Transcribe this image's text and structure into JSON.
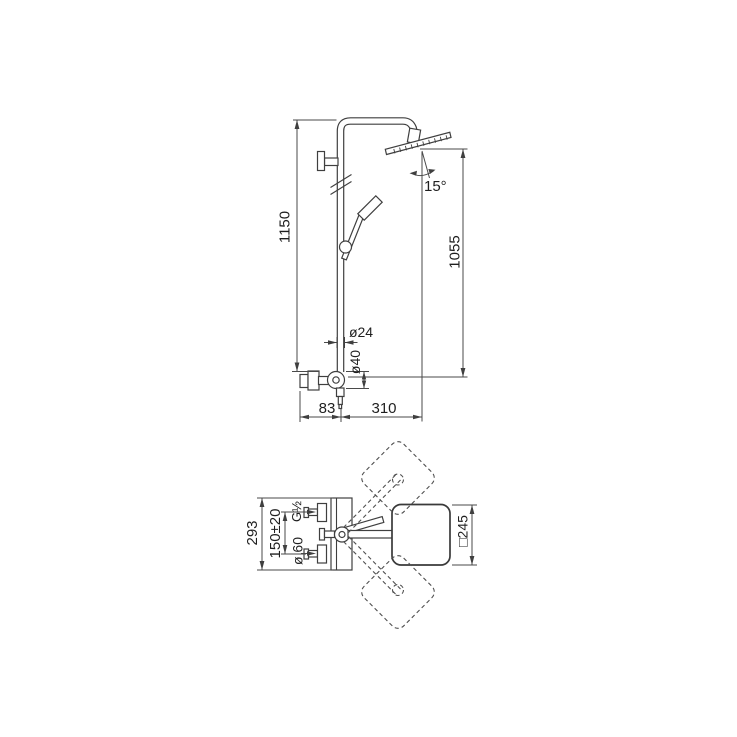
{
  "colors": {
    "background": "#ffffff",
    "line": "#3f3f3f",
    "text": "#1f1f1f"
  },
  "front_view": {
    "dimensions": {
      "total_height": "1150",
      "head_height": "1055",
      "head_tilt_angle": "15°",
      "riser_diameter": "ø24",
      "valve_body_diameter": "ø40",
      "wall_offset": "83",
      "head_reach": "310"
    }
  },
  "top_view": {
    "dimensions": {
      "plate_width": "293",
      "inlet_spacing": "150±20",
      "inlet_thread": "G½",
      "rosette_diameter": "ø 60",
      "head_size": "□245"
    }
  }
}
